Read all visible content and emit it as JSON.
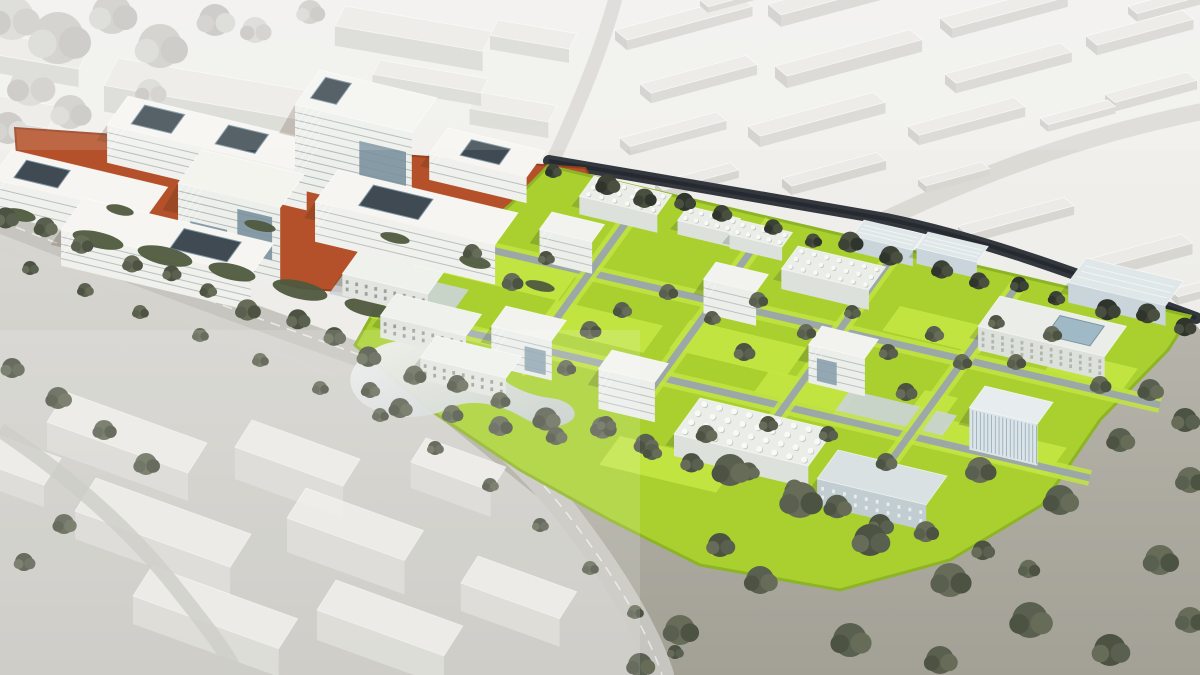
{
  "meta": {
    "alt": "Aerial architectural rendering of a business campus masterplan: white striped office blocks with roof courtyards on a terracotta plaza at left, small glass cube buildings and skylit halls on bright lime-green lawns at right, surrounded by ghosted gray context blocks, tree-lined roads and a small pond",
    "kind": "architectural-rendering"
  },
  "palette": {
    "bg_top": "#f2f1ee",
    "bg_mid": "#e9e8e4",
    "fg_top": "#d8d7d2",
    "fg_bot": "#c6c5bf",
    "warm_top": "#b7b5ab",
    "warm_bot": "#a3a196",
    "block_top": "#ebeae6",
    "block_front": "#d7d6d1",
    "block_side": "#cfcec9",
    "road_light": "#c6c5bf",
    "road_line": "#e8e7e1",
    "road_ctx": "#dbdad5",
    "road_dark": "#33383e",
    "orange": "#b4512a",
    "orange_dark": "#97401f",
    "green": "#a9d02f",
    "green_bright": "#c3e544",
    "green_edge": "#8db424",
    "lawn_pale": "#dde3d0",
    "plaza_pale": "#ccd4d9",
    "street_gray": "#9ba5ad",
    "street_light": "#c3cad0",
    "pond_light": "#f0f1ef",
    "pond_dark": "#c7cdd0",
    "tree_darks": [
      "#4d5342",
      "#5a6050",
      "#666c58"
    ],
    "tree_road": [
      "#2f342c",
      "#3d4236",
      "#4a5040"
    ],
    "tree_faded": [
      "#dad9d5",
      "#cfcec9",
      "#c7c6c1"
    ],
    "shrub": "#4f5a3e"
  },
  "axes": {
    "L": [
      [
        0.985,
        0.17
      ],
      [
        -0.28,
        0.55
      ]
    ],
    "R": [
      [
        0.965,
        -0.26
      ],
      [
        0.5,
        0.42
      ]
    ],
    "S": [
      [
        0.973,
        0.232
      ],
      [
        -0.52,
        0.72
      ]
    ],
    "G": [
      [
        0.94,
        0.34
      ],
      [
        -0.38,
        0.6
      ]
    ]
  },
  "roads": {
    "d_path": "M 615 0 C 600 55 572 120 554 158",
    "c_path": "M 886 219 C 960 185 1060 140 1200 112",
    "b_path": "M 549 161 C 660 180 780 200 886 219 C 990 240 1100 283 1196 318",
    "a_path": "M 0 221 C 120 268 240 312 352 352 C 448 388 520 452 572 520 C 616 578 648 632 662 675",
    "a_side": "M 0 248 C 112 292 224 334 336 376",
    "bl_path": "M 0 430 C 60 470 120 520 168 578 C 200 618 224 648 238 675"
  },
  "site": {
    "orange_poly": [
      [
        15,
        128
      ],
      [
        585,
        168
      ],
      [
        596,
        186
      ],
      [
        540,
        210
      ],
      [
        480,
        232
      ],
      [
        430,
        255
      ],
      [
        395,
        275
      ],
      [
        350,
        292
      ],
      [
        300,
        288
      ],
      [
        240,
        272
      ],
      [
        170,
        252
      ],
      [
        90,
        235
      ],
      [
        20,
        195
      ]
    ],
    "campus_poly": [
      [
        548,
        166
      ],
      [
        1190,
        316
      ],
      [
        1168,
        350
      ],
      [
        1100,
        420
      ],
      [
        1042,
        505
      ],
      [
        950,
        560
      ],
      [
        840,
        590
      ],
      [
        700,
        565
      ],
      [
        610,
        520
      ],
      [
        520,
        470
      ],
      [
        430,
        410
      ],
      [
        355,
        345
      ],
      [
        395,
        275
      ],
      [
        445,
        258
      ],
      [
        510,
        205
      ]
    ],
    "lawns": [
      [
        462,
        244,
        120,
        40
      ],
      [
        556,
        300,
        110,
        38
      ],
      [
        690,
        320,
        120,
        40
      ],
      [
        900,
        306,
        100,
        34
      ],
      [
        620,
        436,
        120,
        40
      ],
      [
        950,
        420,
        120,
        38
      ],
      [
        770,
        370,
        90,
        30
      ],
      [
        1060,
        350,
        80,
        28
      ],
      [
        925,
        390,
        34,
        24
      ]
    ],
    "plazas": [
      [
        352,
        262,
        120,
        44
      ],
      [
        850,
        390,
        110,
        36
      ]
    ],
    "streets_u": [
      [
        372,
        310,
        1090,
        478
      ],
      [
        470,
        245,
        1160,
        405
      ]
    ],
    "streets_v": [
      [
        648,
        192,
        518,
        372
      ],
      [
        772,
        222,
        642,
        402
      ],
      [
        896,
        252,
        766,
        432
      ],
      [
        1020,
        282,
        890,
        462
      ]
    ],
    "pond_path": "M 370 352 C 340 370 345 400 380 412 C 400 420 430 418 450 408 C 470 398 500 404 520 416 C 540 428 560 430 572 420 C 580 412 570 400 550 398 C 520 394 500 380 490 366 C 478 348 440 338 410 340 C 392 341 380 344 370 352 Z"
  },
  "context_blocks": [
    {
      "p": [
        615,
        30
      ],
      "w": 130,
      "d": 24,
      "h": 10
    },
    {
      "p": [
        768,
        4
      ],
      "w": 150,
      "d": 26,
      "h": 12
    },
    {
      "p": [
        940,
        18
      ],
      "w": 120,
      "d": 24,
      "h": 10
    },
    {
      "p": [
        1086,
        36
      ],
      "w": 100,
      "d": 22,
      "h": 10
    },
    {
      "p": [
        700,
        0
      ],
      "w": 90,
      "d": 16,
      "h": 6
    },
    {
      "p": [
        1128,
        6
      ],
      "w": 70,
      "d": 18,
      "h": 8
    },
    {
      "p": [
        640,
        84
      ],
      "w": 110,
      "d": 22,
      "h": 10
    },
    {
      "p": [
        775,
        66
      ],
      "w": 140,
      "d": 24,
      "h": 12
    },
    {
      "p": [
        945,
        74
      ],
      "w": 120,
      "d": 22,
      "h": 10
    },
    {
      "p": [
        1105,
        94
      ],
      "w": 85,
      "d": 20,
      "h": 9
    },
    {
      "p": [
        620,
        138
      ],
      "w": 100,
      "d": 20,
      "h": 9
    },
    {
      "p": [
        748,
        126
      ],
      "w": 130,
      "d": 24,
      "h": 11
    },
    {
      "p": [
        908,
        126
      ],
      "w": 110,
      "d": 22,
      "h": 10
    },
    {
      "p": [
        1040,
        118
      ],
      "w": 70,
      "d": 16,
      "h": 7
    },
    {
      "p": [
        655,
        183
      ],
      "w": 78,
      "d": 17,
      "h": 8
    },
    {
      "p": [
        782,
        178
      ],
      "w": 98,
      "d": 19,
      "h": 9
    },
    {
      "p": [
        918,
        179
      ],
      "w": 66,
      "d": 16,
      "h": 7
    },
    {
      "p": [
        958,
        226
      ],
      "w": 110,
      "d": 20,
      "h": 9
    },
    {
      "p": [
        1085,
        260
      ],
      "w": 100,
      "d": 22,
      "h": 11
    },
    {
      "p": [
        1170,
        290
      ],
      "w": 55,
      "d": 16,
      "h": 8
    }
  ],
  "ghost_top": [
    {
      "p": [
        118,
        58
      ],
      "w": 235,
      "d": 50,
      "h": 26
    },
    {
      "p": [
        0,
        34
      ],
      "w": 90,
      "d": 36,
      "h": 18
    },
    {
      "p": [
        345,
        6
      ],
      "w": 150,
      "d": 36,
      "h": 20
    },
    {
      "p": [
        498,
        20
      ],
      "w": 80,
      "d": 28,
      "h": 14
    },
    {
      "p": [
        0,
        96
      ],
      "w": 60,
      "d": 40,
      "h": 18
    },
    {
      "p": [
        478,
        92
      ],
      "w": 80,
      "d": 30,
      "h": 16
    },
    {
      "p": [
        380,
        60
      ],
      "w": 110,
      "d": 26,
      "h": 13
    }
  ],
  "ghost_bottom": [
    {
      "p": [
        66,
        392
      ],
      "w": 150,
      "d": 50,
      "h": 28
    },
    {
      "p": [
        252,
        420
      ],
      "w": 115,
      "d": 45,
      "h": 32
    },
    {
      "p": [
        96,
        478
      ],
      "w": 165,
      "d": 55,
      "h": 28
    },
    {
      "p": [
        306,
        488
      ],
      "w": 125,
      "d": 50,
      "h": 34
    },
    {
      "p": [
        426,
        438
      ],
      "w": 85,
      "d": 40,
      "h": 26
    },
    {
      "p": [
        152,
        566
      ],
      "w": 155,
      "d": 50,
      "h": 28
    },
    {
      "p": [
        336,
        580
      ],
      "w": 135,
      "d": 50,
      "h": 30
    },
    {
      "p": [
        0,
        436
      ],
      "w": 65,
      "d": 45,
      "h": 22
    },
    {
      "p": [
        478,
        556
      ],
      "w": 105,
      "d": 45,
      "h": 28
    }
  ],
  "cluster": [
    {
      "k": "office-slab",
      "p": [
        128,
        96
      ],
      "w": 205,
      "d": 40,
      "h": 38,
      "c": [
        0.1,
        0.15,
        0.3,
        0.8
      ],
      "c2": [
        0.52,
        0.15,
        0.72,
        0.8
      ]
    },
    {
      "k": "office-slab",
      "p": [
        448,
        128
      ],
      "w": 100,
      "d": 36,
      "h": 26,
      "c": [
        0.28,
        0.2,
        0.68,
        0.8
      ]
    },
    {
      "k": "office-tower",
      "p": [
        320,
        70
      ],
      "w": 120,
      "d": 48,
      "h": 84,
      "c": [
        0.08,
        0.15,
        0.3,
        0.75
      ],
      "g": [
        [
          0.55,
          0.25,
          0.95,
          0.95
        ]
      ]
    },
    {
      "k": "office-slab",
      "p": [
        12,
        150
      ],
      "w": 160,
      "d": 40,
      "h": 34,
      "c": [
        0.12,
        0.2,
        0.4,
        0.8
      ]
    },
    {
      "k": "office-slab",
      "p": [
        338,
        170
      ],
      "w": 185,
      "d": 44,
      "h": 40,
      "c": [
        0.22,
        0.18,
        0.55,
        0.82
      ]
    },
    {
      "k": "office-tower",
      "p": [
        202,
        150
      ],
      "w": 105,
      "d": 46,
      "h": 78,
      "g": [
        [
          0.12,
          0.45,
          0.48,
          0.96
        ],
        [
          0.58,
          0.15,
          0.92,
          0.7
        ]
      ]
    },
    {
      "k": "office-slab",
      "p": [
        84,
        198
      ],
      "w": 195,
      "d": 44,
      "h": 36,
      "c": [
        0.55,
        0.18,
        0.85,
        0.8
      ]
    }
  ],
  "campus": [
    {
      "k": "hall",
      "p": [
        594,
        176
      ],
      "w": 80,
      "d": 28,
      "h": 18,
      "rd": [
        6,
        3
      ]
    },
    {
      "k": "hall",
      "p": [
        688,
        206
      ],
      "w": 54,
      "d": 20,
      "h": 14,
      "rd": [
        5,
        2
      ]
    },
    {
      "k": "hall",
      "p": [
        740,
        220
      ],
      "w": 54,
      "d": 20,
      "h": 14,
      "rd": [
        5,
        2
      ]
    },
    {
      "k": "glass-hall",
      "p": [
        864,
        220
      ],
      "w": 62,
      "d": 22,
      "h": 16
    },
    {
      "k": "campus-cube",
      "p": [
        552,
        212
      ],
      "w": 54,
      "d": 24,
      "h": 32
    },
    {
      "k": "glass-hall",
      "p": [
        928,
        232
      ],
      "w": 62,
      "d": 22,
      "h": 16
    },
    {
      "k": "hall",
      "p": [
        798,
        246
      ],
      "w": 90,
      "d": 32,
      "h": 20,
      "rd": [
        7,
        3
      ]
    },
    {
      "k": "dotted-lowrise",
      "p": [
        358,
        252
      ],
      "w": 88,
      "d": 30,
      "h": 22,
      "fd": [
        2,
        9
      ]
    },
    {
      "k": "glass-hall",
      "p": [
        1086,
        258
      ],
      "w": 100,
      "d": 34,
      "h": 20
    },
    {
      "k": "campus-cube",
      "p": [
        716,
        262
      ],
      "w": 54,
      "d": 24,
      "h": 34
    },
    {
      "k": "dotted-lowrise",
      "p": [
        396,
        294
      ],
      "w": 88,
      "d": 30,
      "h": 22,
      "fd": [
        2,
        9
      ]
    },
    {
      "k": "hall",
      "p": [
        1000,
        296
      ],
      "w": 130,
      "d": 42,
      "h": 24,
      "c": [
        0.5,
        0.15,
        0.85,
        0.8
      ],
      "fd": [
        3,
        13
      ]
    },
    {
      "k": "campus-cube",
      "p": [
        506,
        306
      ],
      "w": 62,
      "d": 28,
      "h": 40,
      "g": [
        [
          0.55,
          0.3,
          0.9,
          0.9
        ]
      ]
    },
    {
      "k": "dotted-lowrise",
      "p": [
        436,
        336
      ],
      "w": 88,
      "d": 30,
      "h": 22,
      "fd": [
        2,
        9
      ]
    },
    {
      "k": "campus-cube",
      "p": [
        822,
        326
      ],
      "w": 58,
      "d": 26,
      "h": 38,
      "g": [
        [
          0.15,
          0.3,
          0.5,
          0.9
        ]
      ]
    },
    {
      "k": "campus-cube",
      "p": [
        612,
        350
      ],
      "w": 58,
      "d": 26,
      "h": 40
    },
    {
      "k": "mullion-cube",
      "p": [
        985,
        386
      ],
      "w": 70,
      "d": 30,
      "h": 42
    },
    {
      "k": "hall",
      "p": [
        700,
        398
      ],
      "w": 138,
      "d": 50,
      "h": 22,
      "rd": [
        9,
        4
      ],
      "rr": 3
    },
    {
      "k": "glass-slab",
      "p": [
        838,
        450
      ],
      "w": 112,
      "d": 40,
      "h": 26,
      "fd": [
        2,
        10
      ]
    }
  ],
  "trees": {
    "rows": [
      {
        "from": [
          560,
          176
        ],
        "to": [
          1186,
          326
        ],
        "n": 16,
        "r": 9,
        "c": "road"
      },
      {
        "from": [
          6,
          214
        ],
        "to": [
          334,
          340
        ],
        "n": 9,
        "r": 9,
        "c": "dark"
      },
      {
        "from": [
          362,
          356
        ],
        "to": [
          1026,
          566
        ],
        "n": 15,
        "r": 10,
        "c": "dark"
      }
    ],
    "a_lower": [
      [
        30,
        268
      ],
      [
        85,
        290
      ],
      [
        140,
        312
      ],
      [
        200,
        335
      ],
      [
        260,
        360
      ],
      [
        320,
        388
      ],
      [
        380,
        415
      ],
      [
        435,
        448
      ],
      [
        490,
        485
      ],
      [
        540,
        525
      ],
      [
        590,
        568
      ],
      [
        635,
        612
      ],
      [
        675,
        652
      ]
    ],
    "campus_scatter": [
      [
        472,
        252,
        8
      ],
      [
        512,
        282,
        9
      ],
      [
        546,
        258,
        7
      ],
      [
        590,
        330,
        9
      ],
      [
        566,
        368,
        8
      ],
      [
        622,
        310,
        8
      ],
      [
        668,
        292,
        8
      ],
      [
        712,
        318,
        7
      ],
      [
        758,
        300,
        8
      ],
      [
        744,
        352,
        9
      ],
      [
        806,
        332,
        8
      ],
      [
        852,
        312,
        7
      ],
      [
        888,
        352,
        8
      ],
      [
        934,
        334,
        8
      ],
      [
        906,
        392,
        9
      ],
      [
        962,
        362,
        8
      ],
      [
        1016,
        362,
        8
      ],
      [
        1052,
        334,
        8
      ],
      [
        996,
        322,
        7
      ],
      [
        706,
        434,
        9
      ],
      [
        768,
        424,
        8
      ],
      [
        828,
        434,
        8
      ],
      [
        886,
        462,
        9
      ],
      [
        652,
        452,
        8
      ],
      [
        606,
        424,
        8
      ]
    ],
    "br_scatter": [
      [
        730,
        470,
        16
      ],
      [
        800,
        500,
        18
      ],
      [
        870,
        540,
        16
      ],
      [
        950,
        580,
        17
      ],
      [
        1030,
        620,
        18
      ],
      [
        1110,
        650,
        16
      ],
      [
        760,
        580,
        14
      ],
      [
        680,
        630,
        15
      ],
      [
        850,
        640,
        17
      ],
      [
        1160,
        560,
        15
      ],
      [
        1190,
        480,
        13
      ],
      [
        1120,
        440,
        12
      ],
      [
        1060,
        500,
        15
      ],
      [
        980,
        470,
        13
      ],
      [
        940,
        660,
        14
      ],
      [
        1190,
        620,
        13
      ],
      [
        720,
        545,
        12
      ],
      [
        640,
        665,
        12
      ],
      [
        1150,
        390,
        11
      ],
      [
        1185,
        420,
        12
      ],
      [
        1100,
        385,
        9
      ]
    ],
    "bl_scatter": [
      [
        12,
        368,
        10
      ],
      [
        58,
        398,
        11
      ],
      [
        104,
        430,
        10
      ],
      [
        146,
        464,
        11
      ],
      [
        64,
        524,
        10
      ],
      [
        24,
        562,
        9
      ]
    ],
    "pond_scatter": [
      [
        400,
        408,
        10
      ],
      [
        452,
        414,
        9
      ],
      [
        500,
        426,
        10
      ],
      [
        556,
        436,
        9
      ],
      [
        370,
        390,
        8
      ]
    ],
    "faded": [
      [
        12,
        18,
        22
      ],
      [
        58,
        38,
        26
      ],
      [
        112,
        14,
        20
      ],
      [
        160,
        46,
        22
      ],
      [
        215,
        20,
        16
      ],
      [
        30,
        86,
        20
      ],
      [
        8,
        128,
        16
      ],
      [
        70,
        112,
        17
      ],
      [
        150,
        92,
        13
      ],
      [
        255,
        30,
        13
      ],
      [
        310,
        12,
        12
      ]
    ],
    "shrubs": [
      [
        98,
        240,
        26,
        8
      ],
      [
        165,
        256,
        28,
        9
      ],
      [
        232,
        272,
        24,
        8
      ],
      [
        300,
        290,
        28,
        9
      ],
      [
        368,
        308,
        24,
        8
      ],
      [
        432,
        326,
        26,
        9
      ],
      [
        120,
        210,
        14,
        5
      ],
      [
        260,
        226,
        16,
        5
      ],
      [
        395,
        238,
        15,
        5
      ],
      [
        475,
        262,
        16,
        6
      ],
      [
        20,
        215,
        16,
        6
      ],
      [
        540,
        286,
        15,
        5
      ]
    ]
  }
}
